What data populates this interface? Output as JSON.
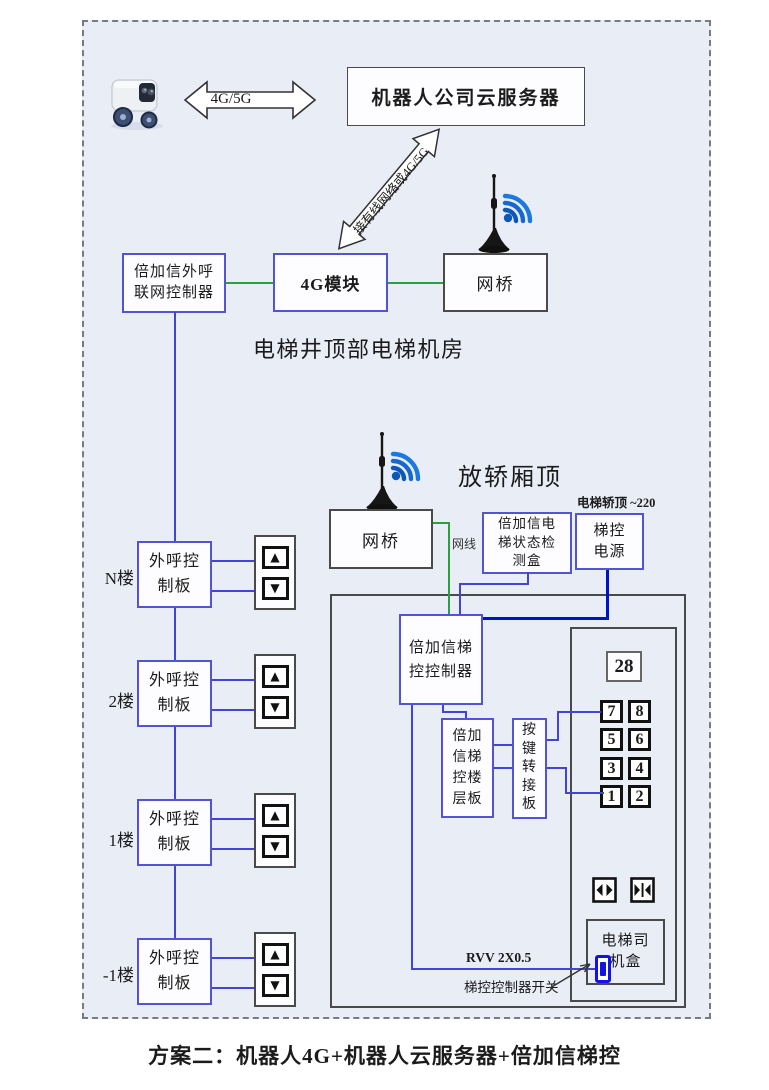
{
  "colors": {
    "canvas_bg": "#e9edf6",
    "box_border_blue": "#5353d6",
    "box_border_dark": "#4a4a4a",
    "wire_green": "#2e9e43",
    "wire_blue": "#4343d8",
    "wire_blue_thick": "#0011cc",
    "switch_blue": "#1313e8",
    "wifi_blue": "#1b78dc"
  },
  "icons": {
    "robot": "delivery-robot",
    "antenna": "antenna-with-wifi",
    "door_open": "door-open",
    "door_close": "door-close",
    "up_glyph": "▲",
    "down_glyph": "▼"
  },
  "top": {
    "link_label": "4G/5G",
    "cloud_server": "机器人公司云服务器",
    "uplink_label": "接有线网络或4G/5G"
  },
  "machine_room": {
    "title": "电梯井顶部电梯机房",
    "outcall_gateway": "倍加信外呼联网控制器",
    "module_4g": "4G模块",
    "bridge": "网桥"
  },
  "cabin": {
    "title": "放轿厢顶",
    "power_note": "电梯轿顶 ~220",
    "bridge": "网桥",
    "cable": "网线",
    "status_detector": "倍加信电梯状态检测盒",
    "power": "梯控电源",
    "controller": "倍加信梯控控制器",
    "floor_board": "倍加信梯控楼层板",
    "key_adapter": "按键转接板",
    "display": "28",
    "buttons": [
      "7",
      "8",
      "5",
      "6",
      "3",
      "4",
      "1",
      "2"
    ],
    "driver_box": "电梯司机盒",
    "cable_spec": "RVV 2X0.5",
    "switch_label": "梯控控制器开关"
  },
  "floors": [
    {
      "label": "N楼",
      "board": "外呼控制板"
    },
    {
      "label": "2楼",
      "board": "外呼控制板"
    },
    {
      "label": "1楼",
      "board": "外呼控制板"
    },
    {
      "label": "-1楼",
      "board": "外呼控制板"
    }
  ],
  "caption": "方案二：机器人4G+机器人云服务器+倍加信梯控"
}
